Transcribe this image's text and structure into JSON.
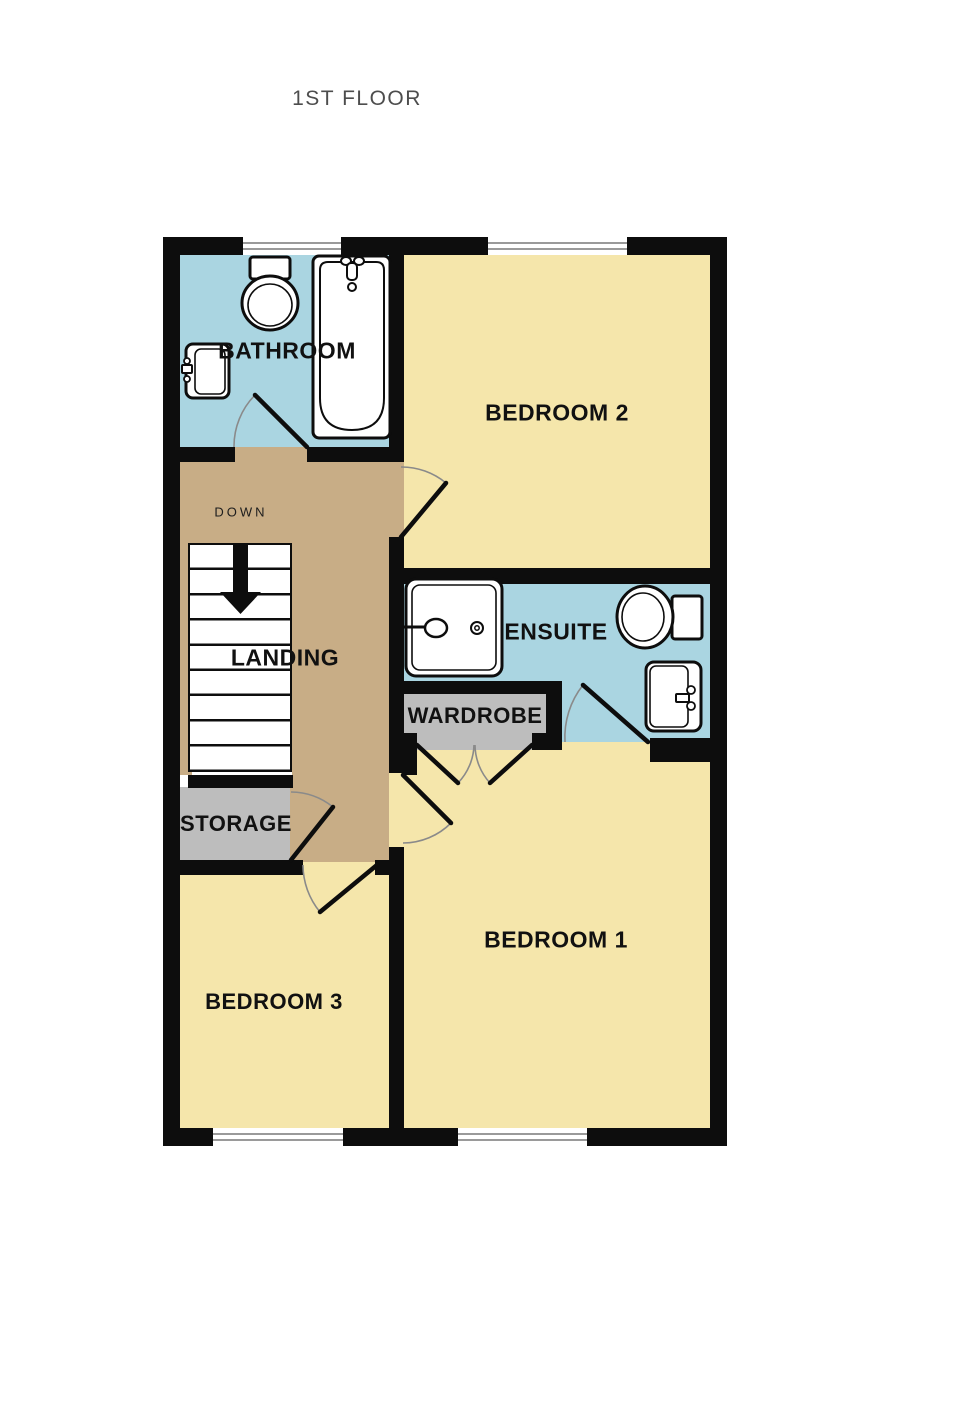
{
  "title": "1ST FLOOR",
  "rooms": {
    "bathroom": "BATHROOM",
    "bedroom2": "BEDROOM 2",
    "landing": "LANDING",
    "ensuite": "ENSUITE",
    "wardrobe": "WARDROBE",
    "storage": "STORAGE",
    "bedroom3": "BEDROOM 3",
    "bedroom1": "BEDROOM 1"
  },
  "stairs": {
    "label": "DOWN",
    "treads": 9,
    "direction": "down"
  },
  "fixtures": {
    "bathroom": [
      "toilet",
      "bathtub",
      "sink"
    ],
    "ensuite": [
      "shower",
      "toilet",
      "sink"
    ]
  },
  "colors": {
    "wall": "#0d0d0d",
    "bedroom_fill": "#f5e6ab",
    "wet_room_fill": "#aad5e1",
    "landing_fill": "#c8ad86",
    "closet_fill": "#bdbdbd",
    "window_line": "#9a9a9a",
    "door_arc": "#8a8a8a",
    "title_text": "#4d4d4d",
    "label_text": "#111111"
  }
}
